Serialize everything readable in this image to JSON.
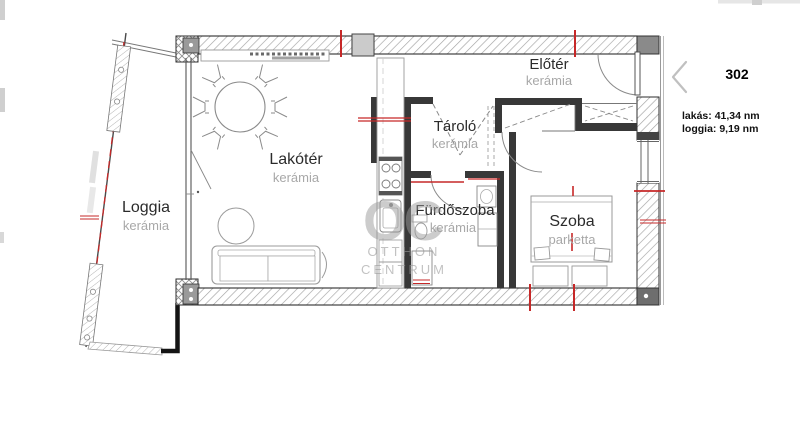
{
  "floorplan": {
    "rooms": [
      {
        "id": "loggia",
        "name": "Loggia",
        "floor": "kerámia"
      },
      {
        "id": "lakoter",
        "name": "Lakótér",
        "floor": "kerámia"
      },
      {
        "id": "tarolo",
        "name": "Tároló",
        "floor": "kerámia"
      },
      {
        "id": "furdoszoba",
        "name": "Fürdőszoba",
        "floor": "kerámia"
      },
      {
        "id": "szoba",
        "name": "Szoba",
        "floor": "parketta"
      },
      {
        "id": "eloter",
        "name": "Előtér",
        "floor": "kerámia"
      }
    ],
    "watermark": {
      "monogram": "OC",
      "line1": "OTTHON",
      "line2": "CENTRUM"
    },
    "colors": {
      "wall_fill": "#383838",
      "hatch": "#a3a3a3",
      "red_accent": "#c62828",
      "furniture": "#999999",
      "label": "#2b2b2b",
      "floor_label": "#a8a8a8"
    }
  },
  "info_panel": {
    "unit_number": "302",
    "chevron": "‹",
    "area_lines": [
      "lakás: 41,34 nm",
      "loggia: 9,19 nm"
    ]
  }
}
